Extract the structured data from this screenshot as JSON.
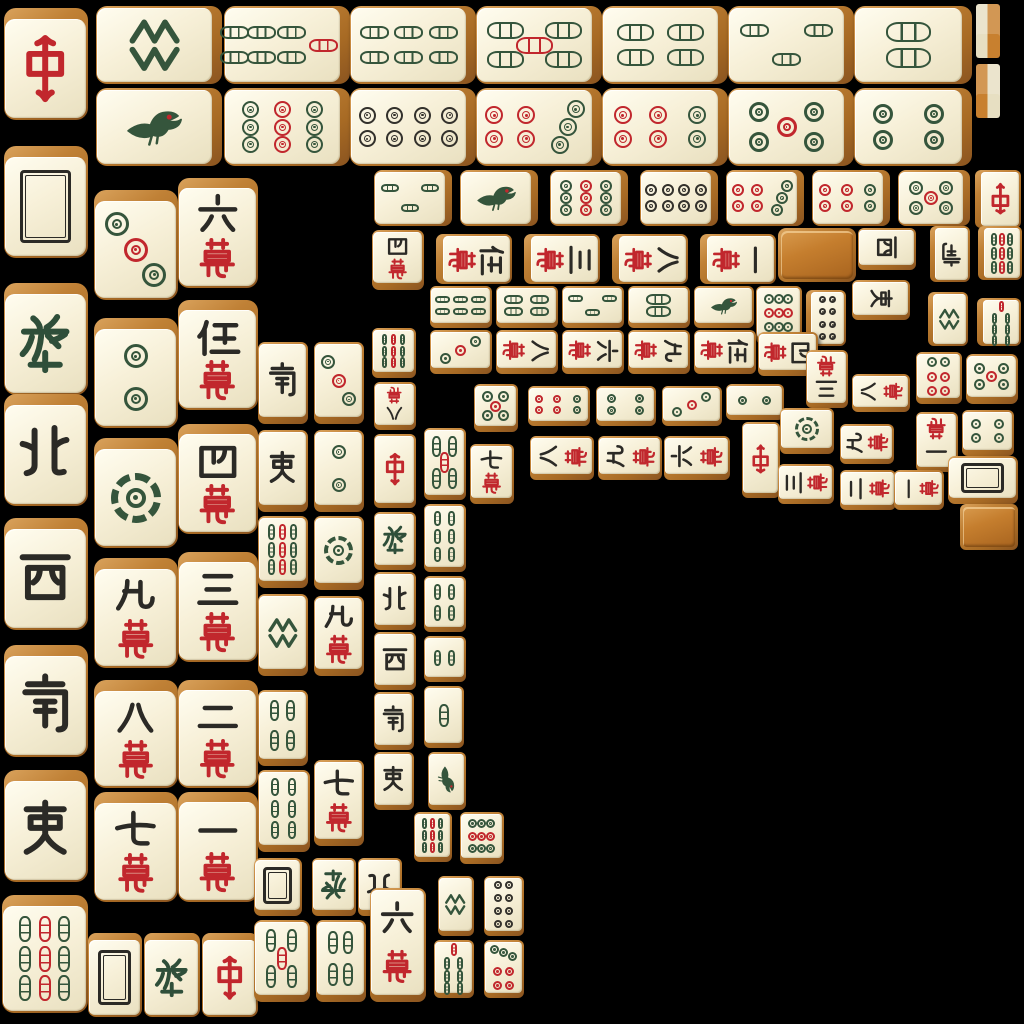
{
  "app": {
    "name": "mahjong-solitaire-board",
    "background": "#000000"
  },
  "board": {
    "width": 1024,
    "height": 1024
  },
  "palette": {
    "background": "#000000",
    "tile_face_light": "#fffdf0",
    "tile_face_dark": "#e9e0c0",
    "tile_side_light": "#d9a25c",
    "tile_side_dark": "#8a5420",
    "tile_back_wood": "#c57e2e",
    "suit_green": "#35553c",
    "suit_red": "#c1272d",
    "suit_black": "#33312c",
    "ink_black": "#2b2a26",
    "dragon_green": "#2f4f3a",
    "dragon_red": "#c1272d"
  },
  "face_legend": {
    "c1": "character-1",
    "c2": "character-2",
    "c3": "character-3",
    "c4": "character-4",
    "c5": "character-5",
    "c6": "character-6",
    "c7": "character-7",
    "c8": "character-8",
    "c9": "character-9",
    "d1": "dot-1",
    "d2": "dot-2",
    "d3": "dot-3",
    "d4": "dot-4",
    "d5": "dot-5",
    "d6": "dot-6",
    "d7": "dot-7",
    "d8": "dot-8",
    "d9": "dot-9",
    "b1": "bamboo-1-bird",
    "b1s": "bamboo-1-stick",
    "b2": "bamboo-2",
    "b3": "bamboo-3",
    "b4": "bamboo-4",
    "b5": "bamboo-5",
    "b6": "bamboo-6",
    "b7": "bamboo-7",
    "b8": "bamboo-8",
    "b9": "bamboo-9",
    "E": "wind-east",
    "S": "wind-south",
    "W": "wind-west",
    "N": "wind-north",
    "Zh": "dragon-red-zhong",
    "Fa": "dragon-green-fa",
    "Wh": "dragon-white",
    "bk": "tile-back-face-down",
    "ed1": "tile-edge-strip",
    "ed2": "tile-edge-strip"
  },
  "tiles": [
    [
      "Zh",
      4,
      8,
      84,
      112,
      "t",
      "u"
    ],
    [
      "Wh",
      4,
      146,
      84,
      112,
      "t",
      "u"
    ],
    [
      "Fa",
      4,
      283,
      84,
      112,
      "t",
      "u"
    ],
    [
      "N",
      4,
      394,
      84,
      112,
      "t",
      "u"
    ],
    [
      "W",
      4,
      518,
      84,
      112,
      "t",
      "u"
    ],
    [
      "S",
      4,
      645,
      84,
      112,
      "t",
      "u"
    ],
    [
      "E",
      4,
      770,
      84,
      112,
      "t",
      "u"
    ],
    [
      "b9",
      2,
      895,
      86,
      118,
      "t",
      "u"
    ],
    [
      "b8",
      96,
      6,
      126,
      78,
      "r",
      "u"
    ],
    [
      "b7",
      224,
      6,
      126,
      78,
      "r",
      "u"
    ],
    [
      "b6",
      350,
      6,
      126,
      78,
      "r",
      "u"
    ],
    [
      "b5",
      476,
      6,
      126,
      78,
      "r",
      "u"
    ],
    [
      "b4",
      602,
      6,
      126,
      78,
      "r",
      "u"
    ],
    [
      "b3",
      728,
      6,
      126,
      78,
      "r",
      "u"
    ],
    [
      "b2",
      854,
      6,
      118,
      78,
      "r",
      "u"
    ],
    [
      "b1",
      96,
      88,
      126,
      78,
      "r",
      "u"
    ],
    [
      "d9",
      224,
      88,
      126,
      78,
      "r",
      "u"
    ],
    [
      "d8",
      350,
      88,
      126,
      78,
      "r",
      "u"
    ],
    [
      "d7",
      476,
      88,
      126,
      78,
      "r",
      "u"
    ],
    [
      "d6",
      602,
      88,
      126,
      78,
      "r",
      "u"
    ],
    [
      "d5",
      728,
      88,
      126,
      78,
      "r",
      "u"
    ],
    [
      "d4",
      854,
      88,
      118,
      78,
      "r",
      "u"
    ],
    [
      "d3",
      94,
      190,
      84,
      110,
      "t",
      "u"
    ],
    [
      "d2",
      94,
      318,
      84,
      110,
      "t",
      "u"
    ],
    [
      "d1",
      94,
      438,
      84,
      110,
      "t",
      "u"
    ],
    [
      "c9",
      94,
      558,
      84,
      110,
      "t",
      "u"
    ],
    [
      "c8",
      94,
      680,
      84,
      108,
      "t",
      "u"
    ],
    [
      "c7",
      94,
      792,
      84,
      110,
      "t",
      "u"
    ],
    [
      "c6",
      178,
      178,
      80,
      110,
      "t",
      "u"
    ],
    [
      "c5",
      178,
      300,
      80,
      110,
      "t",
      "u"
    ],
    [
      "c4",
      178,
      424,
      80,
      110,
      "t",
      "u"
    ],
    [
      "c3",
      178,
      552,
      80,
      110,
      "t",
      "u"
    ],
    [
      "c2",
      178,
      680,
      80,
      108,
      "t",
      "u"
    ],
    [
      "c1",
      178,
      792,
      80,
      110,
      "t",
      "u"
    ],
    [
      "Wh",
      88,
      933,
      54,
      84,
      "t",
      "u"
    ],
    [
      "Fa",
      144,
      933,
      56,
      84,
      "t",
      "u"
    ],
    [
      "Zh",
      202,
      933,
      56,
      84,
      "t",
      "u"
    ],
    [
      "S",
      258,
      342,
      50,
      82,
      "b",
      "u"
    ],
    [
      "E",
      258,
      430,
      50,
      82,
      "b",
      "u"
    ],
    [
      "b9",
      258,
      516,
      50,
      72,
      "b",
      "u"
    ],
    [
      "b8",
      258,
      594,
      50,
      82,
      "b",
      "u"
    ],
    [
      "d3",
      314,
      342,
      50,
      82,
      "b",
      "u"
    ],
    [
      "d2",
      314,
      430,
      50,
      82,
      "b",
      "u"
    ],
    [
      "d1",
      314,
      516,
      50,
      74,
      "b",
      "u"
    ],
    [
      "c9",
      314,
      596,
      50,
      80,
      "b",
      "u"
    ],
    [
      "b9",
      372,
      328,
      44,
      50,
      "b",
      "u"
    ],
    [
      "c8",
      374,
      382,
      42,
      48,
      "b",
      "d"
    ],
    [
      "Zh",
      374,
      434,
      42,
      74,
      "b",
      "u"
    ],
    [
      "Fa",
      374,
      512,
      42,
      58,
      "b",
      "u"
    ],
    [
      "N",
      374,
      572,
      42,
      58,
      "b",
      "u"
    ],
    [
      "W",
      374,
      632,
      42,
      58,
      "b",
      "u"
    ],
    [
      "S",
      374,
      692,
      40,
      58,
      "b",
      "u"
    ],
    [
      "E",
      374,
      752,
      40,
      58,
      "b",
      "u"
    ],
    [
      "b5",
      424,
      428,
      42,
      72,
      "b",
      "u"
    ],
    [
      "b6",
      424,
      504,
      42,
      68,
      "b",
      "u"
    ],
    [
      "b4",
      424,
      576,
      42,
      56,
      "b",
      "u"
    ],
    [
      "b2",
      424,
      636,
      42,
      46,
      "b",
      "u"
    ],
    [
      "b1s",
      424,
      686,
      40,
      62,
      "b",
      "u"
    ],
    [
      "b1",
      428,
      752,
      38,
      58,
      "b",
      "r"
    ],
    [
      "b3",
      374,
      170,
      78,
      56,
      "r",
      "u"
    ],
    [
      "b1",
      460,
      170,
      78,
      56,
      "r",
      "u"
    ],
    [
      "d9",
      550,
      170,
      78,
      56,
      "r",
      "u"
    ],
    [
      "d8",
      640,
      170,
      78,
      56,
      "r",
      "u"
    ],
    [
      "d7",
      726,
      170,
      78,
      56,
      "r",
      "u"
    ],
    [
      "d6",
      812,
      170,
      78,
      56,
      "r",
      "u"
    ],
    [
      "d5",
      898,
      170,
      72,
      56,
      "r",
      "u"
    ],
    [
      "Zh",
      975,
      170,
      46,
      58,
      "l",
      "d"
    ],
    [
      "c4",
      372,
      230,
      52,
      60,
      "b",
      "u"
    ],
    [
      "c5",
      436,
      234,
      76,
      50,
      "l",
      "r"
    ],
    [
      "c3",
      524,
      234,
      76,
      50,
      "l",
      "r"
    ],
    [
      "c8",
      612,
      234,
      76,
      50,
      "l",
      "r"
    ],
    [
      "c1",
      700,
      234,
      76,
      50,
      "l",
      "r"
    ],
    [
      "bk",
      778,
      228,
      78,
      54,
      "n",
      "u"
    ],
    [
      "W",
      858,
      228,
      58,
      42,
      "b",
      "r"
    ],
    [
      "S",
      930,
      226,
      40,
      56,
      "l",
      "d"
    ],
    [
      "b9",
      978,
      226,
      44,
      54,
      "l",
      "u"
    ],
    [
      "b6",
      430,
      286,
      62,
      42,
      "b",
      "u"
    ],
    [
      "b4",
      496,
      286,
      62,
      42,
      "b",
      "u"
    ],
    [
      "b3",
      562,
      286,
      62,
      42,
      "b",
      "u"
    ],
    [
      "b2",
      628,
      286,
      62,
      42,
      "b",
      "u"
    ],
    [
      "b1",
      694,
      286,
      60,
      42,
      "b",
      "u"
    ],
    [
      "d9",
      756,
      286,
      46,
      58,
      "b",
      "u"
    ],
    [
      "d8",
      806,
      290,
      40,
      56,
      "l",
      "u"
    ],
    [
      "E",
      852,
      280,
      58,
      40,
      "b",
      "r"
    ],
    [
      "b8",
      928,
      292,
      40,
      54,
      "l",
      "u"
    ],
    [
      "b7",
      977,
      298,
      44,
      48,
      "l",
      "u"
    ],
    [
      "d3",
      430,
      330,
      62,
      44,
      "b",
      "u"
    ],
    [
      "c8",
      496,
      330,
      62,
      44,
      "b",
      "r"
    ],
    [
      "c6",
      562,
      330,
      62,
      44,
      "b",
      "r"
    ],
    [
      "c9",
      628,
      330,
      62,
      44,
      "b",
      "r"
    ],
    [
      "c5",
      694,
      330,
      62,
      44,
      "b",
      "r"
    ],
    [
      "c4",
      758,
      332,
      60,
      44,
      "b",
      "r"
    ],
    [
      "c3",
      806,
      350,
      42,
      58,
      "b",
      "d"
    ],
    [
      "c8",
      852,
      374,
      58,
      38,
      "b",
      "l"
    ],
    [
      "d6",
      916,
      352,
      46,
      52,
      "b",
      "u"
    ],
    [
      "d5",
      966,
      354,
      52,
      50,
      "b",
      "u"
    ],
    [
      "d5",
      474,
      384,
      44,
      48,
      "b",
      "u"
    ],
    [
      "d6",
      528,
      386,
      62,
      40,
      "b",
      "u"
    ],
    [
      "d4",
      596,
      386,
      60,
      40,
      "b",
      "u"
    ],
    [
      "d3",
      662,
      386,
      60,
      40,
      "b",
      "u"
    ],
    [
      "d2",
      726,
      384,
      58,
      36,
      "b",
      "u"
    ],
    [
      "Zh",
      742,
      422,
      38,
      76,
      "b",
      "d"
    ],
    [
      "d1",
      780,
      408,
      54,
      46,
      "b",
      "u"
    ],
    [
      "c9",
      840,
      424,
      54,
      40,
      "b",
      "l"
    ],
    [
      "c1",
      916,
      412,
      42,
      60,
      "b",
      "d"
    ],
    [
      "d4",
      962,
      410,
      52,
      46,
      "b",
      "u"
    ],
    [
      "c7",
      470,
      444,
      44,
      60,
      "b",
      "u"
    ],
    [
      "c8",
      530,
      436,
      64,
      44,
      "b",
      "l"
    ],
    [
      "c9",
      598,
      436,
      64,
      44,
      "b",
      "l"
    ],
    [
      "c6",
      664,
      436,
      66,
      44,
      "b",
      "l"
    ],
    [
      "c3",
      778,
      464,
      56,
      40,
      "b",
      "l"
    ],
    [
      "c2",
      840,
      470,
      56,
      40,
      "b",
      "l"
    ],
    [
      "c1",
      894,
      470,
      50,
      40,
      "b",
      "l"
    ],
    [
      "Wh",
      948,
      456,
      70,
      48,
      "b",
      "u"
    ],
    [
      "bk",
      960,
      504,
      58,
      46,
      "n",
      "u"
    ],
    [
      "b4",
      258,
      690,
      50,
      76,
      "b",
      "u"
    ],
    [
      "b6",
      258,
      770,
      52,
      82,
      "b",
      "u"
    ],
    [
      "c7",
      314,
      760,
      50,
      86,
      "b",
      "u"
    ],
    [
      "Wh",
      254,
      858,
      48,
      58,
      "b",
      "u"
    ],
    [
      "Fa",
      312,
      858,
      44,
      58,
      "b",
      "d"
    ],
    [
      "N",
      358,
      858,
      44,
      58,
      "b",
      "d"
    ],
    [
      "b5",
      254,
      920,
      56,
      82,
      "b",
      "u"
    ],
    [
      "b4",
      316,
      920,
      50,
      82,
      "b",
      "u"
    ],
    [
      "c6",
      370,
      888,
      56,
      114,
      "b",
      "u"
    ],
    [
      "b9",
      414,
      812,
      38,
      50,
      "b",
      "u"
    ],
    [
      "d9",
      460,
      812,
      44,
      52,
      "b",
      "u"
    ],
    [
      "b8",
      438,
      876,
      36,
      60,
      "b",
      "u"
    ],
    [
      "d8",
      484,
      876,
      40,
      60,
      "b",
      "u"
    ],
    [
      "b7",
      434,
      940,
      40,
      58,
      "b",
      "u"
    ],
    [
      "d7",
      484,
      940,
      40,
      58,
      "b",
      "u"
    ],
    [
      "ed1",
      976,
      4,
      24,
      54,
      "n",
      "u"
    ],
    [
      "ed2",
      976,
      64,
      24,
      54,
      "n",
      "u"
    ]
  ]
}
